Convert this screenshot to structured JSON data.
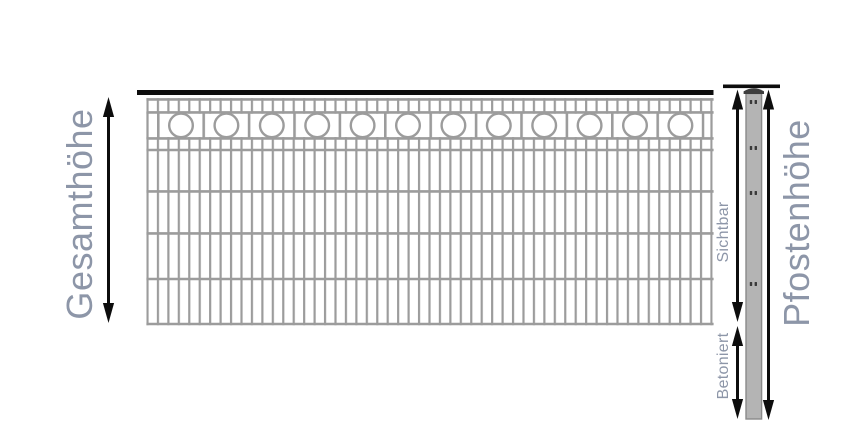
{
  "diagram": {
    "labels": {
      "total_height": "Gesamthöhe",
      "visible": "Sichtbar",
      "concreted": "Betoniert",
      "post_height": "Pfostenhöhe"
    },
    "colors": {
      "label_text": "#8d96a8",
      "mesh_gray": "#9c9c9c",
      "post_fill": "#b4b4b4",
      "post_edge": "#8a8a8a",
      "post_cap": "#3d3d3d",
      "arrow_black": "#0d0d0d",
      "background": "#ffffff"
    },
    "fence": {
      "decorative_circle_count": 12
    }
  }
}
